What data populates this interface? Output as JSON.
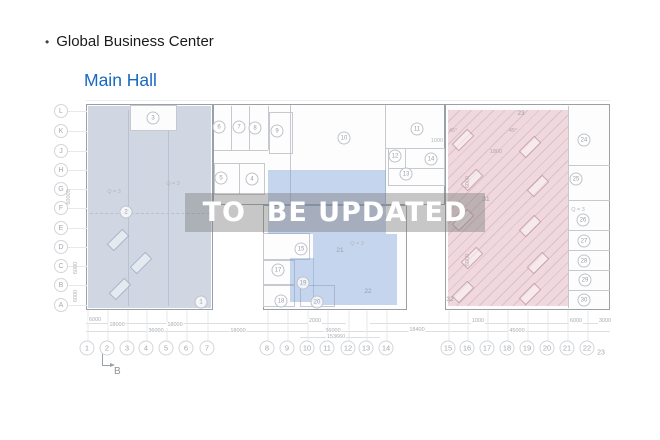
{
  "header": {
    "bullet": "•",
    "title": "Global Business Center",
    "subtitle": "Main Hall"
  },
  "watermark": "TO  BE UPDATED",
  "colors": {
    "link_blue": "#1769c2",
    "zone_left": "#a3b2c7",
    "zone_center": "#7a9eda",
    "zone_right": "#d698aa",
    "watermark_band": "#7a7a7a",
    "watermark_text": "#ffffff"
  },
  "plan": {
    "row_labels": [
      {
        "n": "L",
        "x": 61,
        "y": 111
      },
      {
        "n": "K",
        "x": 61,
        "y": 131
      },
      {
        "n": "J",
        "x": 61,
        "y": 151
      },
      {
        "n": "H",
        "x": 61,
        "y": 170
      },
      {
        "n": "G",
        "x": 61,
        "y": 189
      },
      {
        "n": "F",
        "x": 61,
        "y": 208
      },
      {
        "n": "E",
        "x": 61,
        "y": 228
      },
      {
        "n": "D",
        "x": 61,
        "y": 247
      },
      {
        "n": "C",
        "x": 61,
        "y": 266
      },
      {
        "n": "B",
        "x": 61,
        "y": 285
      },
      {
        "n": "A",
        "x": 61,
        "y": 305
      }
    ],
    "col_labels": [
      {
        "n": "1",
        "x": 87,
        "y": 348
      },
      {
        "n": "2",
        "x": 107,
        "y": 348
      },
      {
        "n": "3",
        "x": 127,
        "y": 348
      },
      {
        "n": "4",
        "x": 146,
        "y": 348
      },
      {
        "n": "5",
        "x": 166,
        "y": 348
      },
      {
        "n": "6",
        "x": 186,
        "y": 348
      },
      {
        "n": "7",
        "x": 207,
        "y": 348
      },
      {
        "n": "8",
        "x": 267,
        "y": 348
      },
      {
        "n": "9",
        "x": 287,
        "y": 348
      },
      {
        "n": "10",
        "x": 307,
        "y": 348
      },
      {
        "n": "11",
        "x": 327,
        "y": 348
      },
      {
        "n": "12",
        "x": 348,
        "y": 348
      },
      {
        "n": "13",
        "x": 366,
        "y": 348
      },
      {
        "n": "14",
        "x": 386,
        "y": 348
      },
      {
        "n": "15",
        "x": 448,
        "y": 348
      },
      {
        "n": "16",
        "x": 467,
        "y": 348
      },
      {
        "n": "17",
        "x": 487,
        "y": 348
      },
      {
        "n": "18",
        "x": 507,
        "y": 348
      },
      {
        "n": "19",
        "x": 527,
        "y": 348
      },
      {
        "n": "20",
        "x": 547,
        "y": 348
      },
      {
        "n": "21",
        "x": 567,
        "y": 348
      },
      {
        "n": "22",
        "x": 587,
        "y": 348
      },
      {
        "n": "23",
        "x": 601,
        "y": 353,
        "cls": "plain"
      }
    ],
    "rooms": [
      {
        "n": "2",
        "x": 126,
        "y": 212
      },
      {
        "n": "3",
        "x": 153,
        "y": 118
      },
      {
        "n": "1",
        "x": 201,
        "y": 302
      },
      {
        "n": "5",
        "x": 221,
        "y": 178
      },
      {
        "n": "4",
        "x": 252,
        "y": 179
      },
      {
        "n": "6",
        "x": 219,
        "y": 127
      },
      {
        "n": "7",
        "x": 239,
        "y": 127
      },
      {
        "n": "8",
        "x": 255,
        "y": 128
      },
      {
        "n": "9",
        "x": 277,
        "y": 131
      },
      {
        "n": "10",
        "x": 344,
        "y": 138
      },
      {
        "n": "11",
        "x": 417,
        "y": 129
      },
      {
        "n": "12",
        "x": 395,
        "y": 156
      },
      {
        "n": "13",
        "x": 406,
        "y": 174
      },
      {
        "n": "14",
        "x": 431,
        "y": 159
      },
      {
        "n": "15",
        "x": 301,
        "y": 249
      },
      {
        "n": "17",
        "x": 278,
        "y": 270
      },
      {
        "n": "19",
        "x": 303,
        "y": 283
      },
      {
        "n": "18",
        "x": 281,
        "y": 301
      },
      {
        "n": "20",
        "x": 317,
        "y": 302
      },
      {
        "n": "21",
        "x": 340,
        "y": 251,
        "cls": "plain"
      },
      {
        "n": "22",
        "x": 368,
        "y": 292,
        "cls": "plain"
      },
      {
        "n": "23",
        "x": 521,
        "y": 114,
        "cls": "plain"
      },
      {
        "n": "31",
        "x": 486,
        "y": 200,
        "cls": "plain"
      },
      {
        "n": "32",
        "x": 450,
        "y": 300,
        "cls": "plain"
      },
      {
        "n": "24",
        "x": 584,
        "y": 140
      },
      {
        "n": "25",
        "x": 576,
        "y": 179
      },
      {
        "n": "26",
        "x": 583,
        "y": 220
      },
      {
        "n": "27",
        "x": 584,
        "y": 241
      },
      {
        "n": "28",
        "x": 584,
        "y": 261
      },
      {
        "n": "29",
        "x": 585,
        "y": 280
      },
      {
        "n": "30",
        "x": 584,
        "y": 300
      }
    ],
    "annotations": [
      {
        "text": "Q = 3",
        "x": 173,
        "y": 184
      },
      {
        "text": "Q = 3",
        "x": 114,
        "y": 192
      },
      {
        "text": "Q = 3",
        "x": 357,
        "y": 244
      },
      {
        "text": "Q = 3",
        "x": 578,
        "y": 210
      },
      {
        "text": "45°",
        "x": 453,
        "y": 131,
        "cls": "pk"
      },
      {
        "text": "45°",
        "x": 513,
        "y": 131,
        "cls": "pk"
      },
      {
        "text": "1800",
        "x": 496,
        "y": 152,
        "cls": "pk"
      },
      {
        "text": "1000",
        "x": 437,
        "y": 141
      }
    ],
    "dims_bottom": [
      {
        "text": "6000",
        "x": 95,
        "y": 320
      },
      {
        "text": "18000",
        "x": 117,
        "y": 325
      },
      {
        "text": "18000",
        "x": 175,
        "y": 325
      },
      {
        "text": "36000",
        "x": 156,
        "y": 331
      },
      {
        "text": "18000",
        "x": 238,
        "y": 331
      },
      {
        "text": "2000",
        "x": 315,
        "y": 321
      },
      {
        "text": "36000",
        "x": 333,
        "y": 331
      },
      {
        "text": "153660",
        "x": 336,
        "y": 337
      },
      {
        "text": "1000",
        "x": 478,
        "y": 321
      },
      {
        "text": "18400",
        "x": 417,
        "y": 330
      },
      {
        "text": "45000",
        "x": 517,
        "y": 331
      },
      {
        "text": "6000",
        "x": 576,
        "y": 321
      },
      {
        "text": "3000",
        "x": 605,
        "y": 321
      }
    ],
    "dims_side": [
      {
        "text": "60000",
        "x": 69,
        "y": 197
      },
      {
        "text": "6000",
        "x": 76,
        "y": 268
      },
      {
        "text": "6000",
        "x": 76,
        "y": 296
      },
      {
        "text": "6000",
        "x": 468,
        "y": 182,
        "cls": "pk"
      },
      {
        "text": "6000",
        "x": 468,
        "y": 260,
        "cls": "pk"
      }
    ],
    "desks": [
      {
        "x": 463,
        "y": 140
      },
      {
        "x": 472,
        "y": 180
      },
      {
        "x": 463,
        "y": 220
      },
      {
        "x": 472,
        "y": 258
      },
      {
        "x": 463,
        "y": 292
      },
      {
        "x": 530,
        "y": 147
      },
      {
        "x": 538,
        "y": 186
      },
      {
        "x": 530,
        "y": 226
      },
      {
        "x": 538,
        "y": 263
      },
      {
        "x": 530,
        "y": 294
      },
      {
        "x": 118,
        "y": 240,
        "cls": "blue"
      },
      {
        "x": 141,
        "y": 263,
        "cls": "blue"
      },
      {
        "x": 120,
        "y": 289,
        "cls": "blue"
      }
    ],
    "section_marker": {
      "label": "B"
    }
  }
}
